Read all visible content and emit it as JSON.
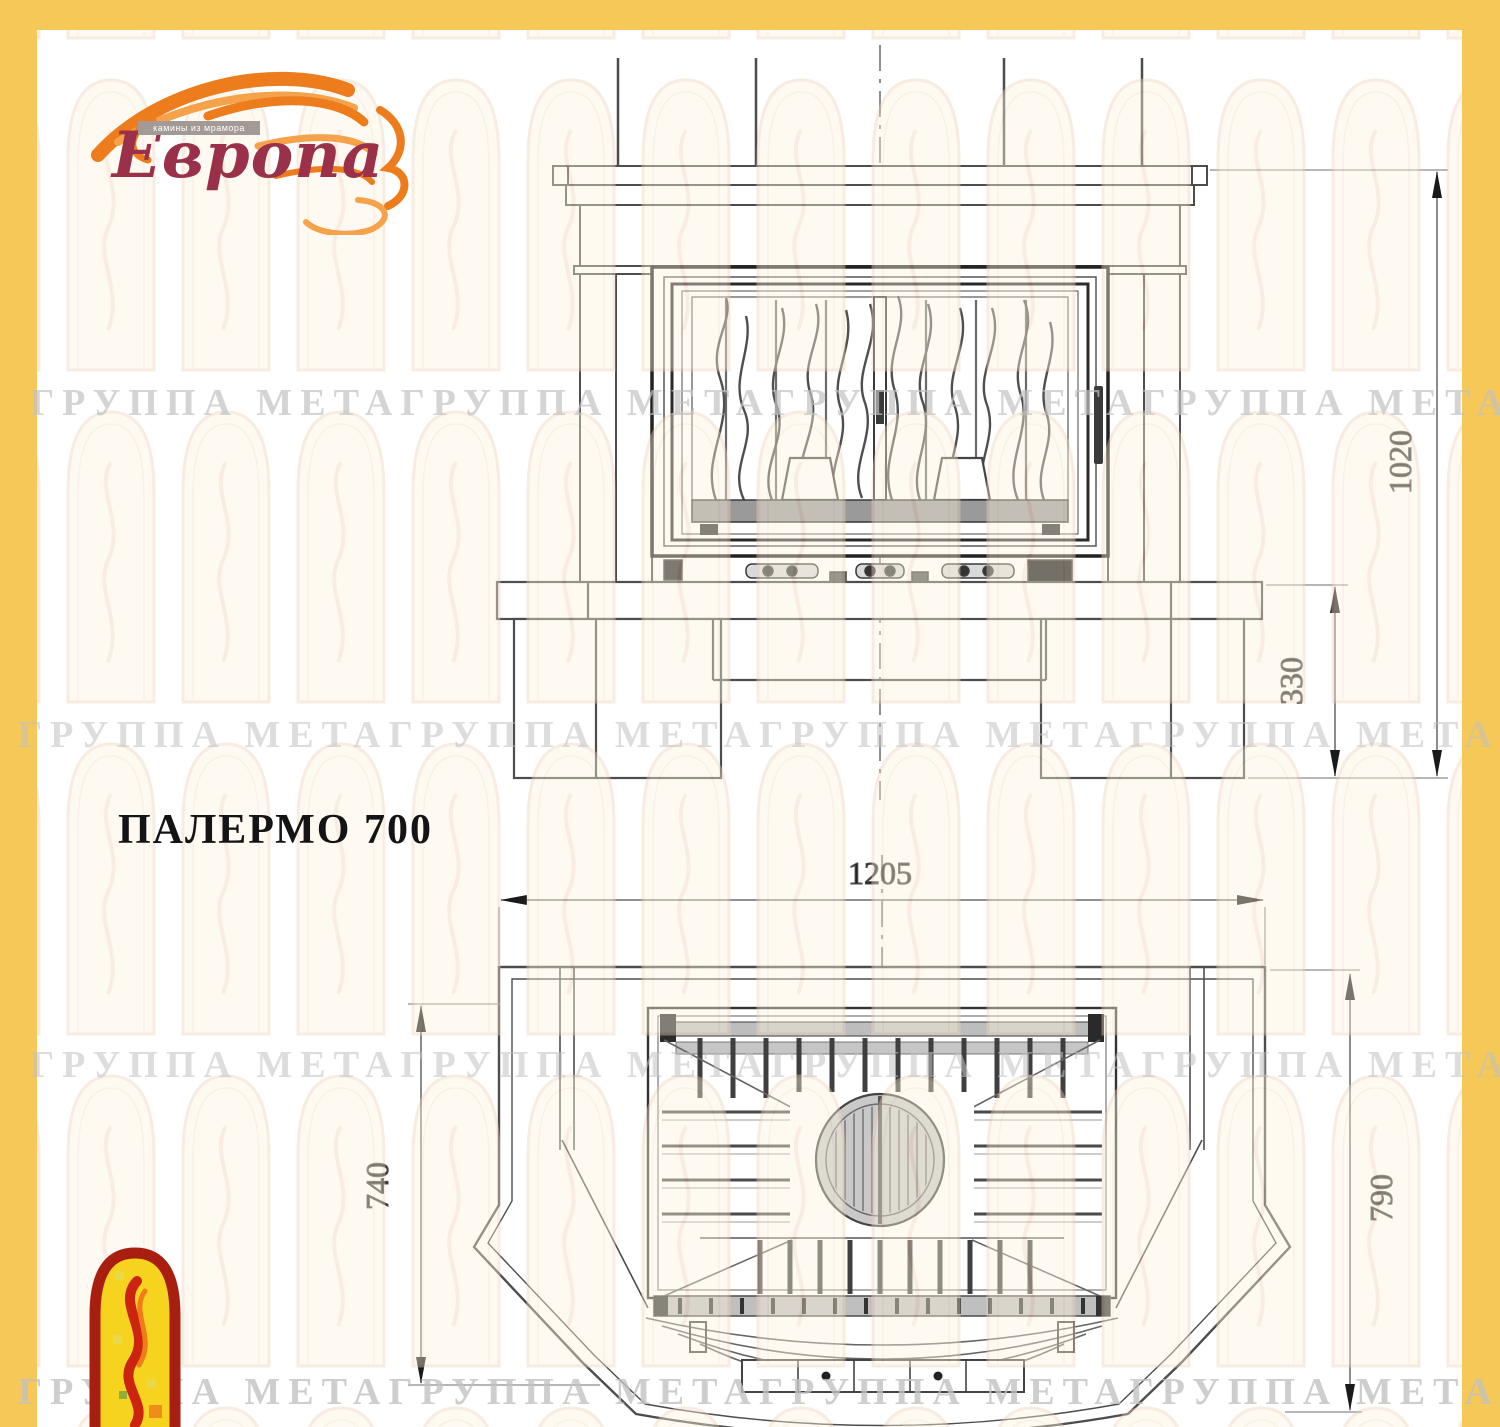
{
  "page": {
    "frame_color": "#f5c857",
    "paper_color": "#ffffff"
  },
  "logo": {
    "brand": "Европа",
    "tagline": "камины из мрамора",
    "flame_color": "#ec7c1c",
    "text_color": "#9a3049"
  },
  "title": "ПАЛЕРМО 700",
  "watermark": {
    "text": "ГРУППА МЕТАГРУППА МЕТАГРУППА МЕТАГРУППА МЕТА",
    "color": "#c2c2c2"
  },
  "drawing": {
    "line_color": "#4d4d4d",
    "front_view": {
      "height_total_mm": "1020",
      "hearth_height_mm": "330"
    },
    "plan_view": {
      "width_mm": "1205",
      "depth_side_mm": "740",
      "depth_front_mm": "790"
    }
  },
  "emblem": {
    "fill": "#f6d31f",
    "border": "#a81e10"
  }
}
